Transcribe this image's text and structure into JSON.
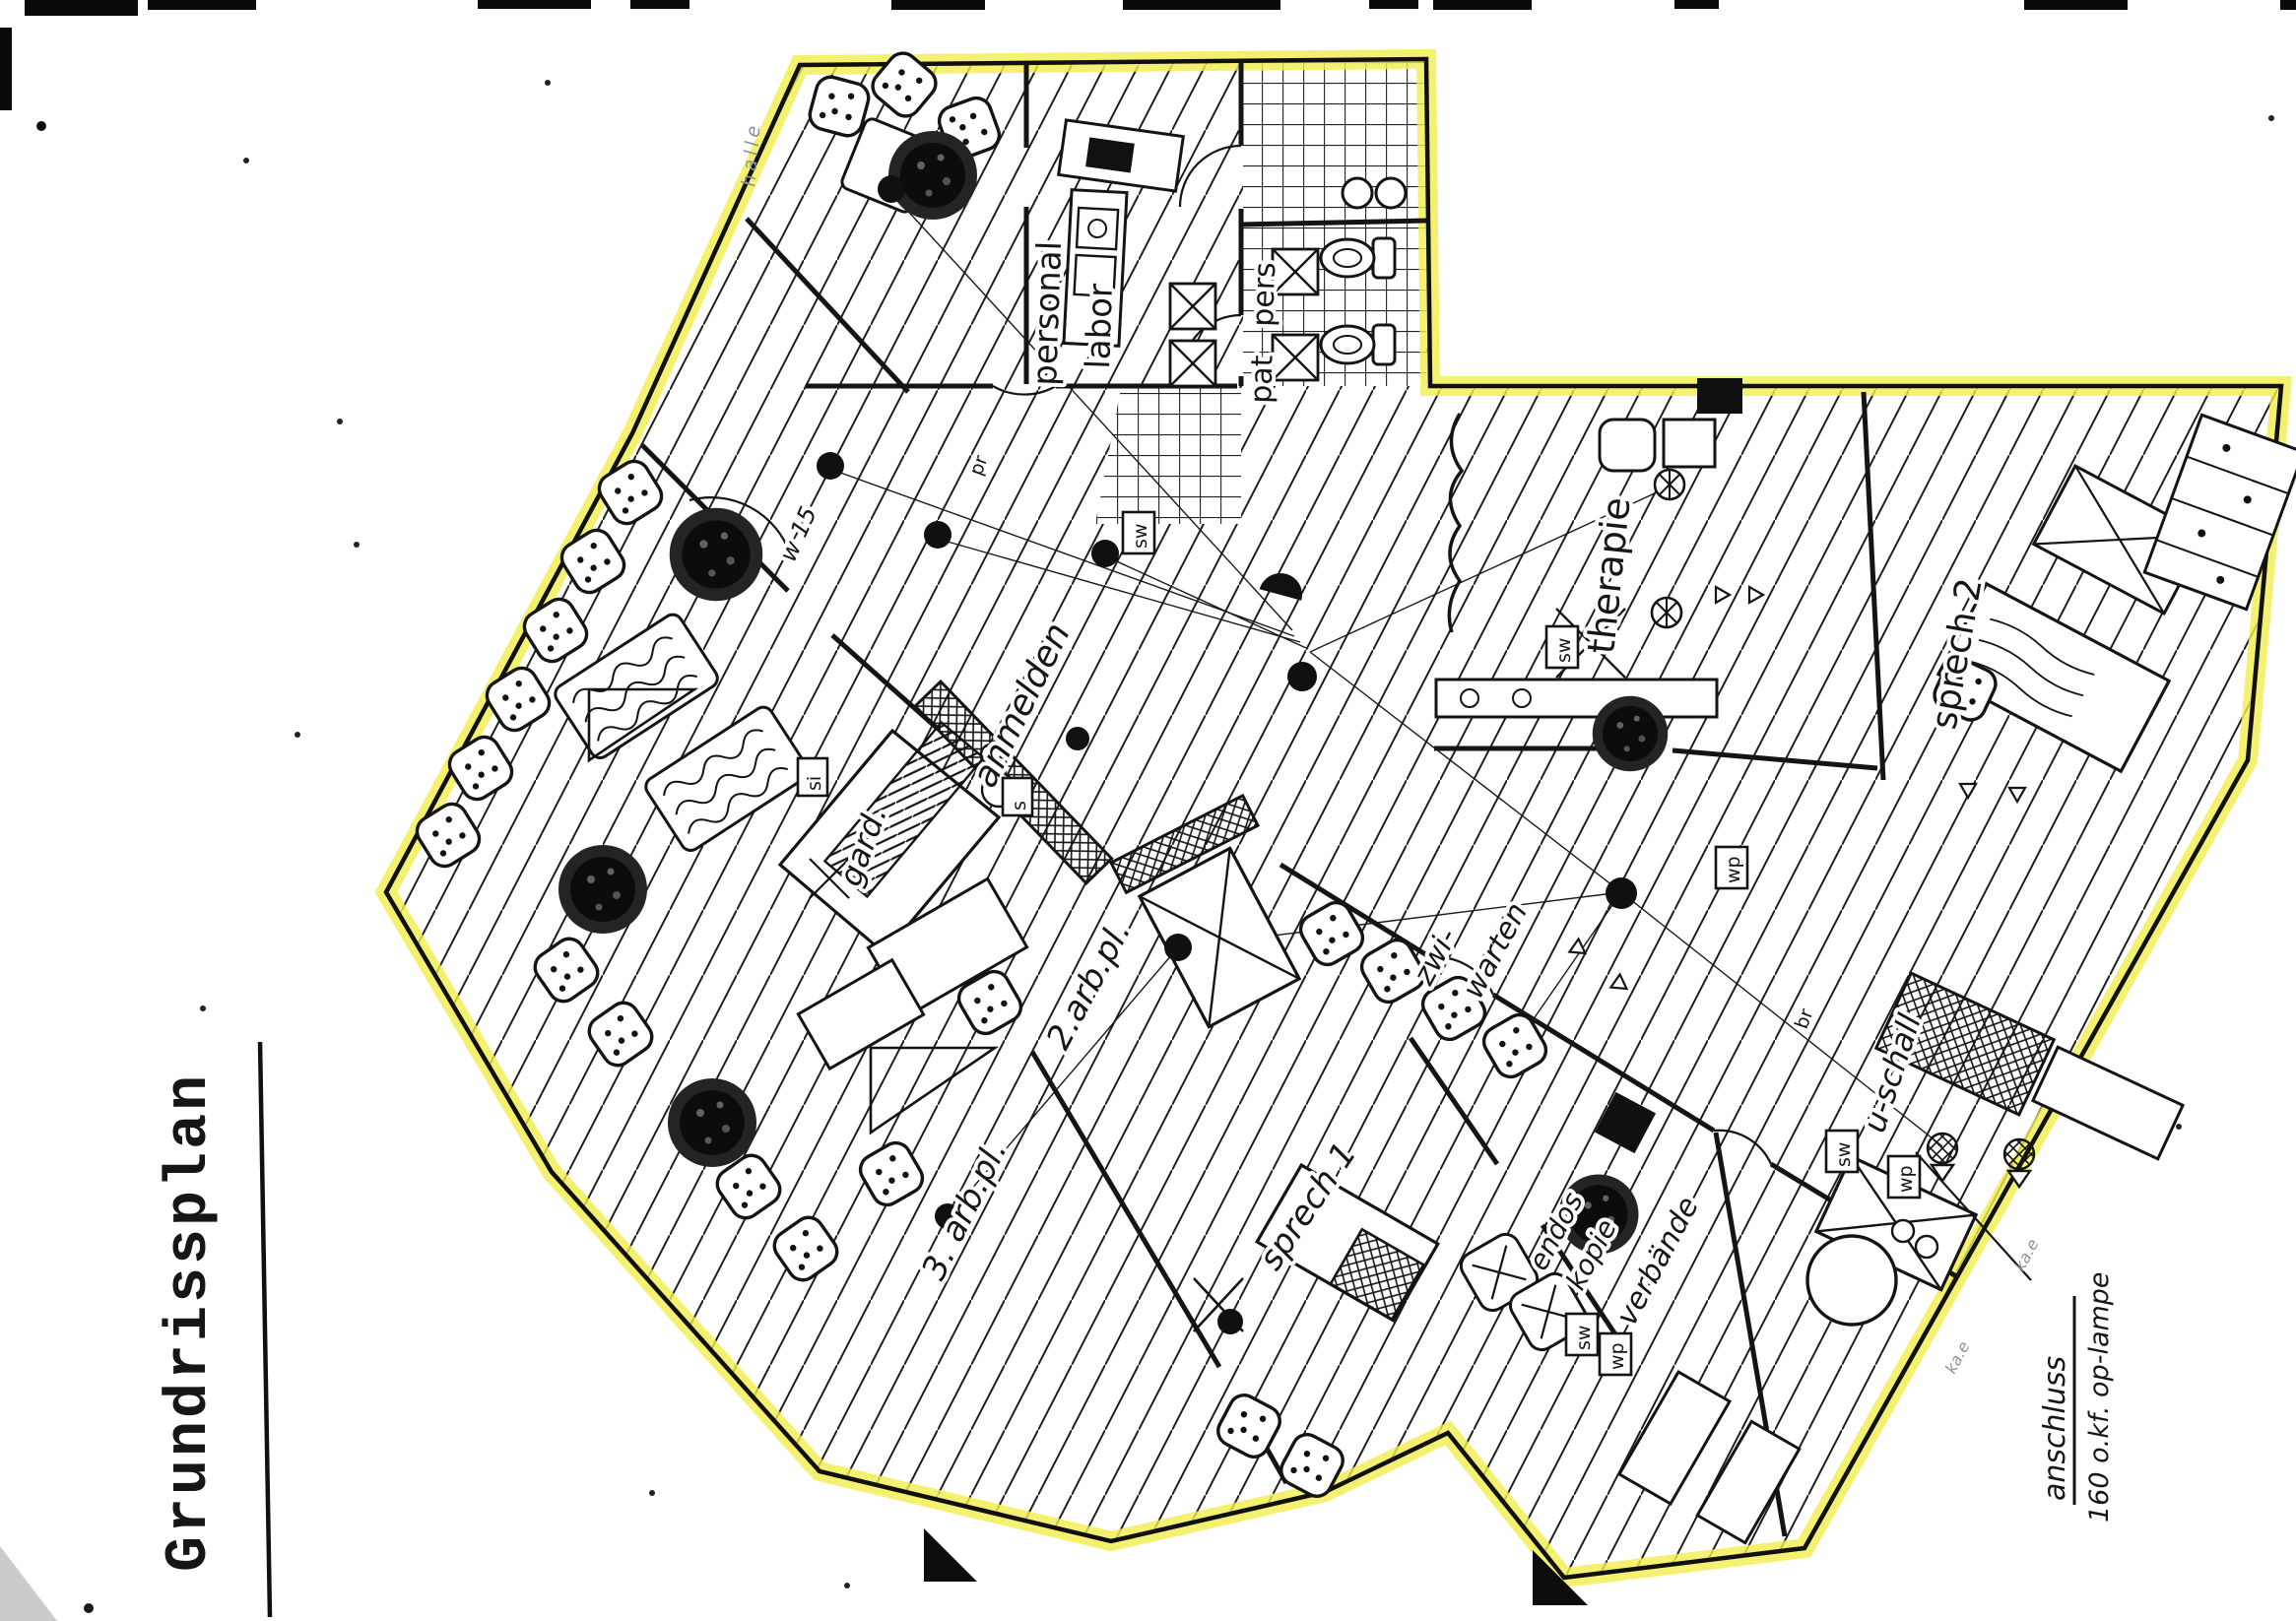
{
  "document": {
    "title": "Grundrissplan"
  },
  "plan": {
    "room_labels": {
      "personal": "personal",
      "labor": "labor",
      "pers": "pers",
      "pat": "pat",
      "therapie": "therapie",
      "sprech_2": "sprech 2",
      "anmelden": "anmelden",
      "garderobe": "gard.",
      "arbeitsplatz_2": "2.arb.pl.",
      "zwischenwarten_line1": "zwi-",
      "zwischenwarten_line2": "warten",
      "arbeitsplatz_3": "3. arb.pl.",
      "sprech_1": "sprech 1",
      "ultraschall": "u-schall",
      "endoskopie_line1": "endos",
      "endoskopie_line2": "kopie",
      "verbaende": "verbände",
      "w_note": "w 15"
    },
    "equipment_labels": {
      "sw": "sw",
      "wp": "wp",
      "br": "br",
      "pr": "pr",
      "s": "s",
      "si": "si"
    },
    "callout": {
      "line1": "anschluss",
      "line2": "160 o.kf.  op-lampe"
    },
    "pencil_notes": {
      "top": "halle",
      "bottom_right_1": "ka.e",
      "bottom_right_2": "ka.e"
    }
  },
  "colors": {
    "highlighter": "#f1ee4e",
    "ink": "#181818",
    "pencil": "#8d9296",
    "paper": "#ffffff"
  }
}
